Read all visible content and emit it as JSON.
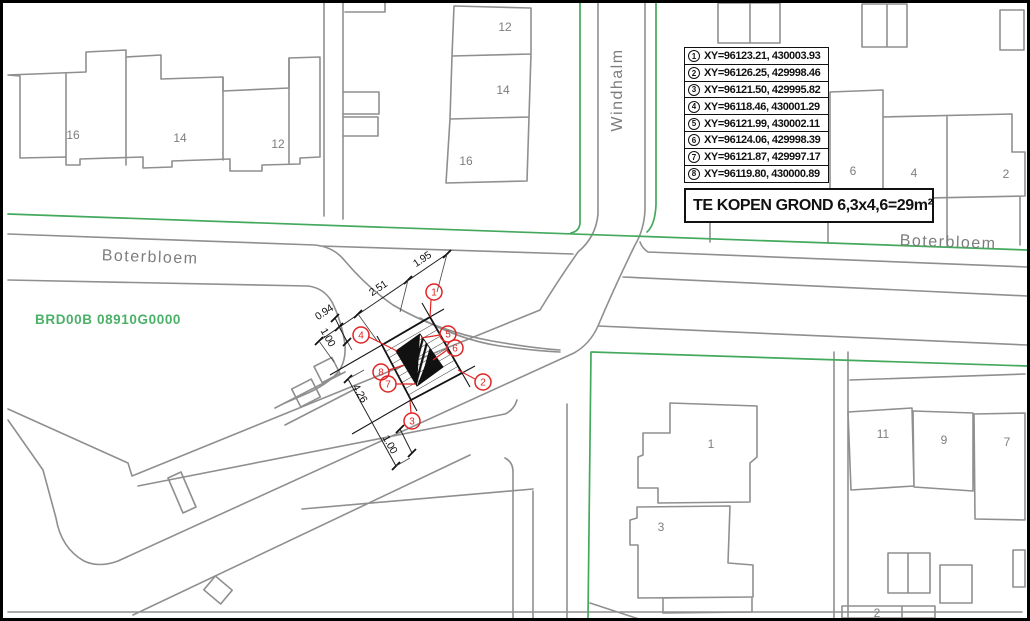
{
  "table": {
    "rows": [
      {
        "num": "1",
        "text": "XY=96123.21, 430003.93"
      },
      {
        "num": "2",
        "text": "XY=96126.25, 429998.46"
      },
      {
        "num": "3",
        "text": "XY=96121.50, 429995.82"
      },
      {
        "num": "4",
        "text": "XY=96118.46, 430001.29"
      },
      {
        "num": "5",
        "text": "XY=96121.99, 430002.11"
      },
      {
        "num": "6",
        "text": "XY=96124.06, 429998.39"
      },
      {
        "num": "7",
        "text": "XY=96121.87, 429997.17"
      },
      {
        "num": "8",
        "text": "XY=96119.80, 430000.89"
      }
    ]
  },
  "sale_box": {
    "label": "TE KOPEN GROND 6,3x4,6=29m²"
  },
  "streets": {
    "boterbloem_west": "Boterbloem",
    "windhalm": "Windhalm",
    "boterbloem_east": "Boterbloem"
  },
  "parcel_id": {
    "label": "BRD00B 08910G0000"
  },
  "houses": {
    "row_nw": [
      "16",
      "14",
      "12"
    ],
    "col_n": [
      "12",
      "14",
      "16"
    ],
    "row_ne": [
      "6",
      "4",
      "2"
    ],
    "se_left": [
      "1",
      "3"
    ],
    "se_right": [
      "11",
      "9",
      "7"
    ],
    "bottom": "2"
  },
  "dimensions": {
    "d1": "1.95",
    "d2": "2.51",
    "d3": "0.94",
    "d4": "1.00",
    "d5": "4.26",
    "d6": "1.00"
  },
  "markers": [
    "1",
    "2",
    "3",
    "4",
    "5",
    "6",
    "7",
    "8"
  ],
  "colors": {
    "line_gray": "#8f8f8f",
    "boundary_green": "#43a95c",
    "parcel_green": "#4bb068",
    "marker_red": "#e02424",
    "ink_black": "#141414"
  }
}
